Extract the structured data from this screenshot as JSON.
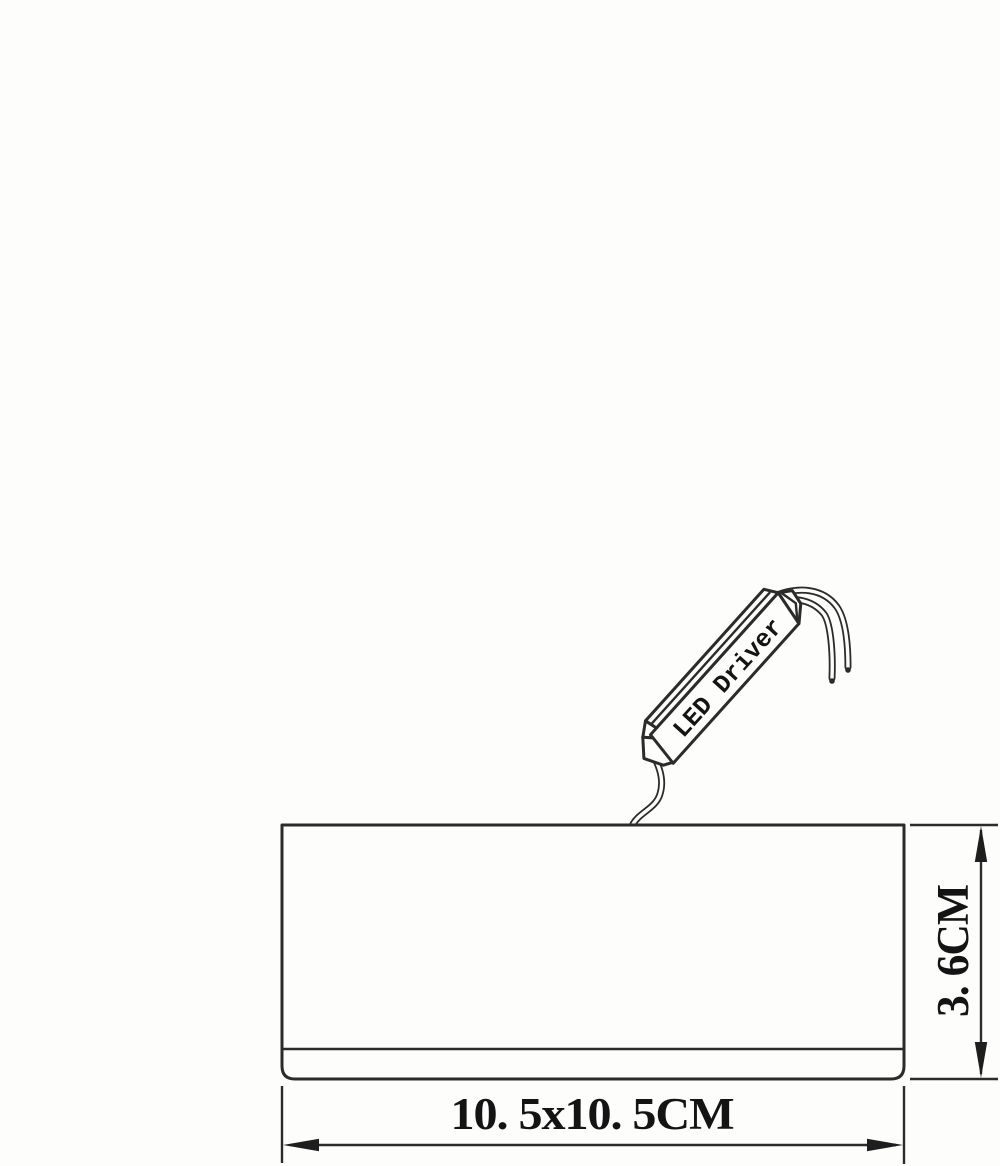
{
  "diagram": {
    "type": "technical-dimension-drawing",
    "background_color": "#fdfdfc",
    "line_color": "#2b2b2b",
    "text_color": "#141414",
    "driver": {
      "label": "LED Driver"
    },
    "fixture": {
      "shape": "rectangle",
      "height_cm": 3.6,
      "footprint_cm": "10.5x10.5"
    },
    "dimensions": {
      "height_label": "3. 6CM",
      "width_label": "10. 5x10. 5CM"
    }
  }
}
